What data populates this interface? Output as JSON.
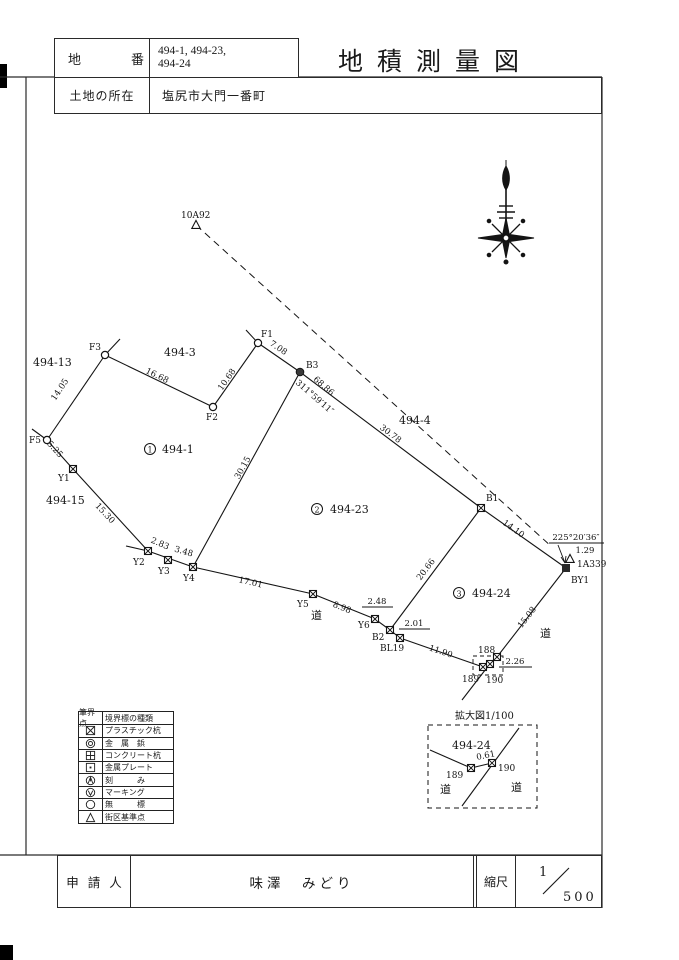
{
  "header": {
    "lot_label": "地番",
    "lot_value_line1": "494-1, 494-23,",
    "lot_value_line2": "494-24",
    "title": "地積測量図",
    "location_label": "土地の所在",
    "location_value": "塩尻市大門一番町"
  },
  "footer": {
    "applicant_label": "申請人",
    "applicant_name": "味澤　みどり",
    "scale_label": "縮尺",
    "scale_numerator": "1",
    "scale_denominator": "500"
  },
  "map": {
    "control_points": {
      "p10a92": "10A92",
      "p1a339": "1A339"
    },
    "points": {
      "f1": "F1",
      "f2": "F2",
      "f3": "F3",
      "f5": "F5",
      "y1": "Y1",
      "y2": "Y2",
      "y3": "Y3",
      "y4": "Y4",
      "y5": "Y5",
      "y6": "Y6",
      "b1": "B1",
      "b2": "B2",
      "b3": "B3",
      "bl19": "BL19",
      "by1": "BY1",
      "p188": "188",
      "p189": "189",
      "p190": "190"
    },
    "distances": {
      "f3f2": "16.68",
      "f2f1": "10.68",
      "f1b3": "7.08",
      "f3f5": "14.05",
      "f5y1": "5.25",
      "y1y2": "15.30",
      "y2y3": "2.83",
      "y3y4": "3.48",
      "y4y5": "17.01",
      "y5y6": "8.98",
      "y6b2": "2.48",
      "b2bl19": "2.01",
      "bl19p189": "11.90",
      "b3y4": "30.15",
      "b3b1": "30.78",
      "b1b2": "20.66",
      "b1by1": "14.10",
      "by1p188": "15.08",
      "p188p190": "2.26",
      "ref_line": "68.86",
      "by1_1a339": "1.29"
    },
    "bearings": {
      "ref_line": "311°59′11″",
      "by1": "225°20′36″"
    },
    "parcels": {
      "p494_1": "494-1",
      "p494_3": "494-3",
      "p494_4": "494-4",
      "p494_13": "494-13",
      "p494_15": "494-15",
      "p494_23": "494-23",
      "p494_24": "494-24",
      "n1": "1",
      "n2": "2",
      "n3": "3"
    },
    "road": "道",
    "enlargement": {
      "title": "拡大図1/100",
      "parcel": "494-24",
      "p189": "189",
      "p190": "190",
      "dist": "0.61",
      "road_left": "道",
      "road_right": "道"
    }
  },
  "legend": {
    "header_col1": "筆界点",
    "header_col2": "境界標の種類",
    "rows": [
      {
        "symbol": "square-x-icon",
        "label": "プラスチック杭"
      },
      {
        "symbol": "double-circle-icon",
        "label": "金　属　鋲"
      },
      {
        "symbol": "square-cross-icon",
        "label": "コンクリート杭"
      },
      {
        "symbol": "square-dot-icon",
        "label": "金属プレート"
      },
      {
        "symbol": "circle-notch-icon",
        "label": "刻　　　み"
      },
      {
        "symbol": "circle-check-icon",
        "label": "マーキング"
      },
      {
        "symbol": "circle-icon",
        "label": "無　　　標"
      },
      {
        "symbol": "triangle-icon",
        "label": "街区基準点"
      }
    ]
  },
  "colors": {
    "ink": "#1a1a1a",
    "paper": "#ffffff"
  }
}
